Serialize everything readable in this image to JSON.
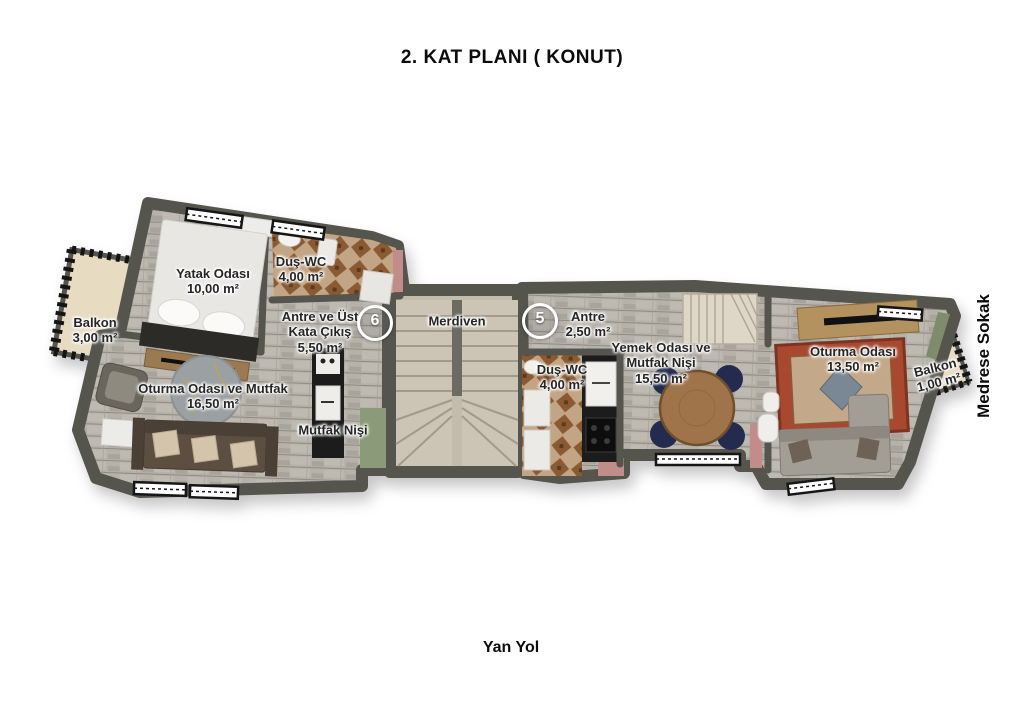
{
  "title": "2. KAT PLANI ( KONUT)",
  "streets": {
    "bottom": "Yan Yol",
    "right": "Medrese Sokak"
  },
  "markers": {
    "unit6": "6",
    "unit5": "5"
  },
  "rooms": {
    "yatak_odasi": {
      "name": "Yatak Odası",
      "area": "10,00 m²"
    },
    "dus_wc_left": {
      "name": "Duş-WC",
      "area": "4,00 m²"
    },
    "balkon_left": {
      "name": "Balkon",
      "area": "3,00 m²"
    },
    "antre_ust_kata_cikis": {
      "name": "Antre ve Üst\nKata Çıkış",
      "area": "5,50 m²"
    },
    "merdiven": {
      "name": "Merdiven"
    },
    "antre": {
      "name": "Antre",
      "area": "2,50 m²"
    },
    "dus_wc_right": {
      "name": "Duş-WC",
      "area": "4,00 m²"
    },
    "yemek_odasi": {
      "name": "Yemek Odası ve\nMutfak Nişi",
      "area": "15,50 m²"
    },
    "oturma_odasi_mutfak": {
      "name": "Oturma Odası ve Mutfak",
      "area": "16,50 m²"
    },
    "mutfak_nisi": {
      "name": "Mutfak Nişi"
    },
    "oturma_odasi": {
      "name": "Oturma Odası",
      "area": "13,50 m²"
    },
    "balkon_right": {
      "name": "Balkon",
      "area": "1,00 m²"
    }
  },
  "palette": {
    "wall": "#55554e",
    "floor_plank": "#b6b2a9",
    "tile_brown": "#8a5a33",
    "stair_stone": "#c3bbac",
    "balcony_floor": "#e7dbc2",
    "green_roof": "#8b9b79",
    "pink_accent": "#c18c8a",
    "rug_red": "#a8492f",
    "table_wood": "#a0744a",
    "chair_navy": "#232c4e",
    "sofa_brown": "#5c4f41",
    "sofa_gray": "#a29e96"
  }
}
